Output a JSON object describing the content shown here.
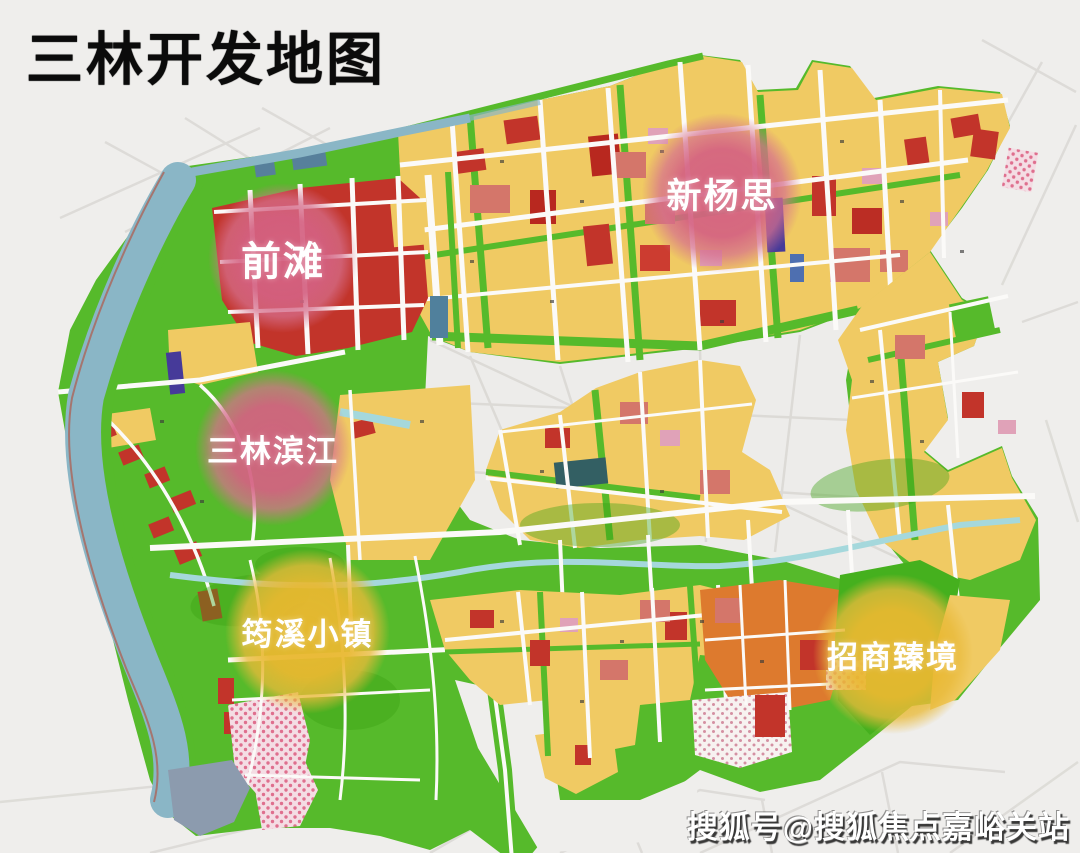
{
  "title": "三林开发地图",
  "watermark": "搜狐号@搜狐焦点嘉峪关站",
  "map": {
    "type": "urban-development-zoning-map",
    "district_labels": [
      {
        "id": "qiantan",
        "label": "前滩",
        "badge_color": "#d46282",
        "text_color": "#ffffff",
        "shape": "soft-circle"
      },
      {
        "id": "xinyangsi",
        "label": "新杨思",
        "badge_color": "#d46282",
        "text_color": "#ffffff",
        "shape": "soft-circle"
      },
      {
        "id": "sanlin-binjiang",
        "label": "三林滨江",
        "badge_color": "#d46282",
        "text_color": "#ffffff",
        "shape": "soft-circle"
      },
      {
        "id": "yunxi-town",
        "label": "筠溪小镇",
        "badge_color": "#e9b830",
        "text_color": "#ffffff",
        "shape": "soft-circle"
      },
      {
        "id": "zhaoshang-zhenjing",
        "label": "招商臻境",
        "badge_color": "#e9b830",
        "text_color": "#ffffff",
        "shape": "soft-circle"
      }
    ],
    "land_use_colors": {
      "residential_yellow": "#f0ca63",
      "park_green": "#56ba2b",
      "commercial_red": "#c2342a",
      "mixed_salmon": "#d4766a",
      "rose_pink": "#e0a2b8",
      "industrial_orange": "#dd7a2e",
      "river_blue": "#8ab6c6",
      "canal_blue": "#a5d8dc",
      "institution_violet": "#463a99",
      "dock_gray": "#8c9bae",
      "road_white": "#fbfaf8",
      "background": "#efeeec"
    }
  }
}
